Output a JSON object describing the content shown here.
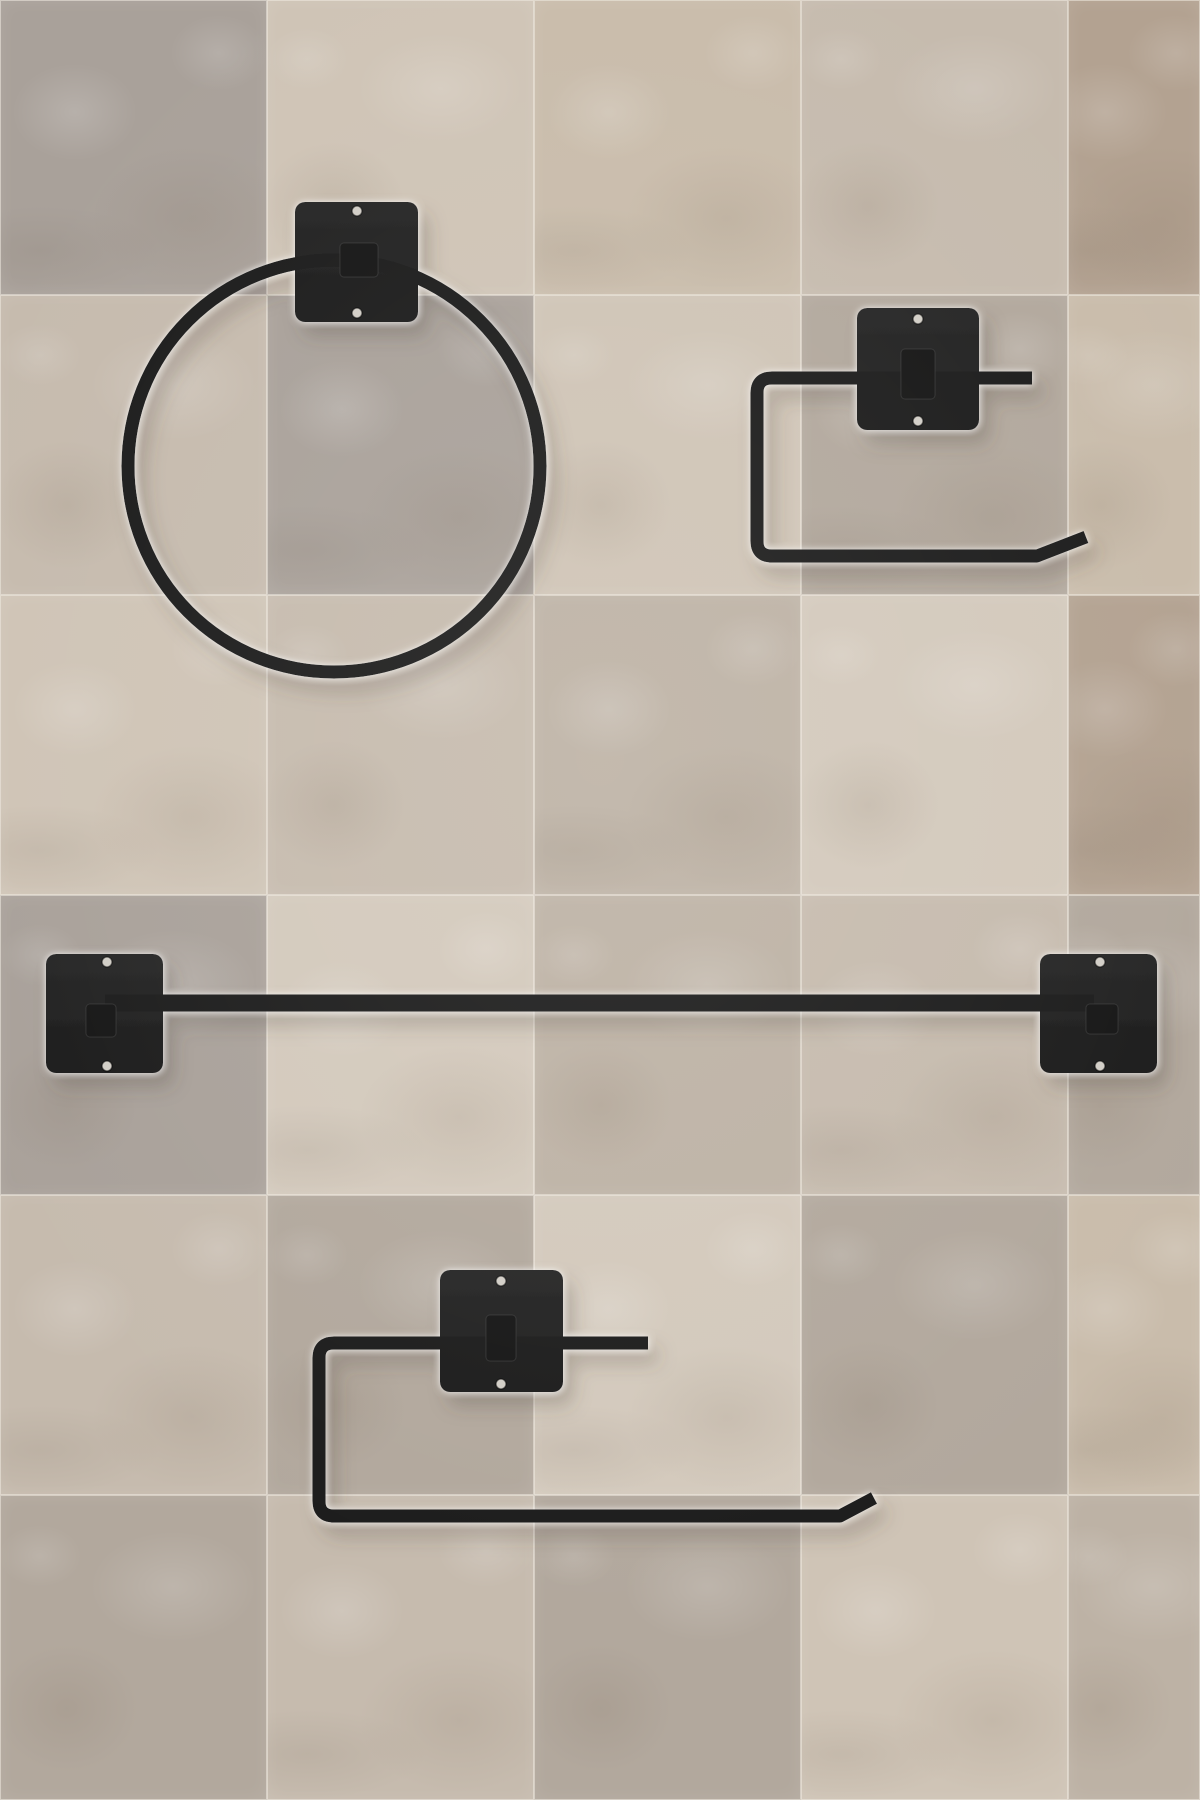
{
  "scene": {
    "type": "product-photo",
    "description": "Four-piece matte black wall-mounted bathroom hardware set photographed on a beige stone tile wall: towel ring, toilet paper holder, long towel bar, paper towel holder",
    "colors": {
      "hardware_black": "#1e1e1e",
      "plate_black": "#202020",
      "tab_black": "#171717",
      "screw_light": "#d2cec7",
      "shadow_warm": "#4a4036",
      "halo_white": "#ffffff",
      "grout_light": "#f1ebe2"
    },
    "background": {
      "tile_palette": [
        "#cfc4b6",
        "#b2a89d",
        "#a9a19a",
        "#c6bbae",
        "#d3c9bc",
        "#bdb2a5",
        "#b3a291",
        "#c9bcab"
      ],
      "col_x": [
        0,
        267,
        534,
        801,
        1068
      ],
      "col_w": [
        267,
        267,
        267,
        267,
        132
      ],
      "row_y": [
        0,
        295,
        595,
        895,
        1195,
        1495
      ],
      "row_h": [
        295,
        300,
        300,
        300,
        300,
        305
      ],
      "tile_map": [
        [
          2,
          0,
          7,
          3,
          6
        ],
        [
          3,
          2,
          0,
          1,
          7
        ],
        [
          0,
          3,
          5,
          4,
          6
        ],
        [
          2,
          4,
          5,
          3,
          1
        ],
        [
          3,
          1,
          4,
          1,
          7
        ],
        [
          1,
          3,
          1,
          0,
          5
        ]
      ]
    },
    "items": [
      {
        "id": "towel-ring",
        "label": "towel ring",
        "position": "top-left",
        "plates": [
          {
            "x": 295,
            "y": 202,
            "w": 123,
            "h": 120
          }
        ],
        "screws": [
          [
            357,
            211
          ],
          [
            357,
            313
          ]
        ],
        "tabs": [
          {
            "x": 340,
            "y": 243,
            "w": 38,
            "h": 34
          }
        ],
        "rings": [
          {
            "cx": 334,
            "cy": 466,
            "r": 206,
            "t": 13
          }
        ],
        "tubes": []
      },
      {
        "id": "toilet-paper-holder",
        "label": "toilet paper holder",
        "position": "top-right",
        "plates": [
          {
            "x": 857,
            "y": 308,
            "w": 122,
            "h": 122
          }
        ],
        "screws": [
          [
            918,
            319
          ],
          [
            918,
            421
          ]
        ],
        "tabs": [
          {
            "x": 901,
            "y": 349,
            "w": 34,
            "h": 50
          }
        ],
        "rings": [],
        "tubes": [
          {
            "d": "M 1032 378 L 772 378 Q 757 378 757 393 L 757 541 Q 757 556 772 556 L 1037 556 L 1086 537",
            "t": 13
          }
        ]
      },
      {
        "id": "towel-bar",
        "label": "towel bar",
        "position": "middle",
        "plates": [
          {
            "x": 46,
            "y": 954,
            "w": 117,
            "h": 119
          },
          {
            "x": 1040,
            "y": 954,
            "w": 117,
            "h": 119
          }
        ],
        "screws": [
          [
            107,
            962
          ],
          [
            107,
            1066
          ],
          [
            1100,
            962
          ],
          [
            1100,
            1066
          ]
        ],
        "tabs": [
          {
            "x": 86,
            "y": 1004,
            "w": 30,
            "h": 33
          },
          {
            "x": 1086,
            "y": 1004,
            "w": 32,
            "h": 30
          }
        ],
        "rings": [],
        "tubes": [
          {
            "d": "M 105 1003 L 1094 1003",
            "t": 17
          }
        ]
      },
      {
        "id": "paper-towel-holder",
        "label": "paper towel holder",
        "position": "bottom",
        "plates": [
          {
            "x": 440,
            "y": 1270,
            "w": 123,
            "h": 122
          }
        ],
        "screws": [
          [
            501,
            1281
          ],
          [
            501,
            1384
          ]
        ],
        "tabs": [
          {
            "x": 486,
            "y": 1315,
            "w": 30,
            "h": 46
          }
        ],
        "rings": [],
        "tubes": [
          {
            "d": "M 648 1343 L 334 1343 Q 319 1343 319 1358 L 319 1501 Q 319 1516 334 1516 L 840 1516 L 874 1498",
            "t": 13
          }
        ]
      }
    ]
  }
}
